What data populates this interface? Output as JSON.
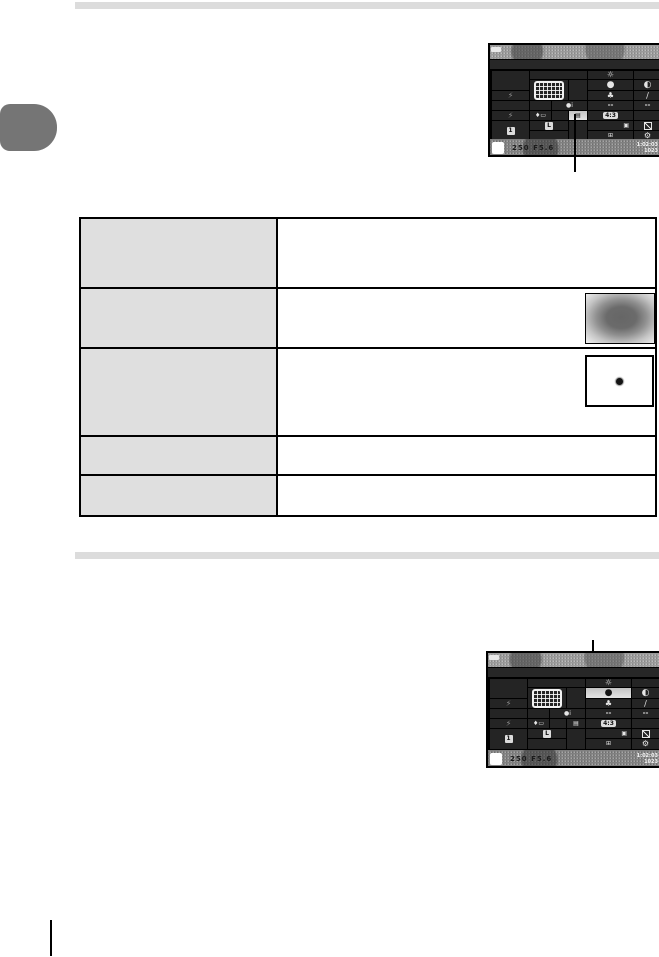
{
  "page": {
    "background": "#ffffff",
    "divider_bar_color": "#dcdcdc",
    "side_tab_color": "#757575",
    "table_header_column_color": "#dfdfdf"
  },
  "table": {
    "rows": [
      {
        "term": "",
        "description": ""
      },
      {
        "term": "",
        "description": "",
        "illustration": "center-weighted-metering-diagram"
      },
      {
        "term": "",
        "description": "",
        "illustration": "spot-metering-diagram"
      },
      {
        "term": "",
        "description": ""
      },
      {
        "term": "",
        "description": ""
      }
    ]
  },
  "camera_panel": {
    "shutter_speed": "250",
    "aperture": "F5.6",
    "time_remaining": "1:02:03",
    "shots_remaining": "1023",
    "aspect_ratio_label": "4:3",
    "info_label": "●i",
    "placeholder_value": "--",
    "image_quality_large": "L",
    "stabilizer_mode": "1",
    "icons": {
      "white_balance_icon": "☼",
      "metering_icon": "●",
      "contrast_icon": "◐",
      "color_icon": "♣",
      "sharpness_icon": "∕",
      "flash_icon": "⚡",
      "flash_comp_icon": "♦▭",
      "image_size_icon": "▤",
      "frames_icon": "▣",
      "edit_icon": "⊞",
      "gear_icon": "⚙"
    }
  }
}
